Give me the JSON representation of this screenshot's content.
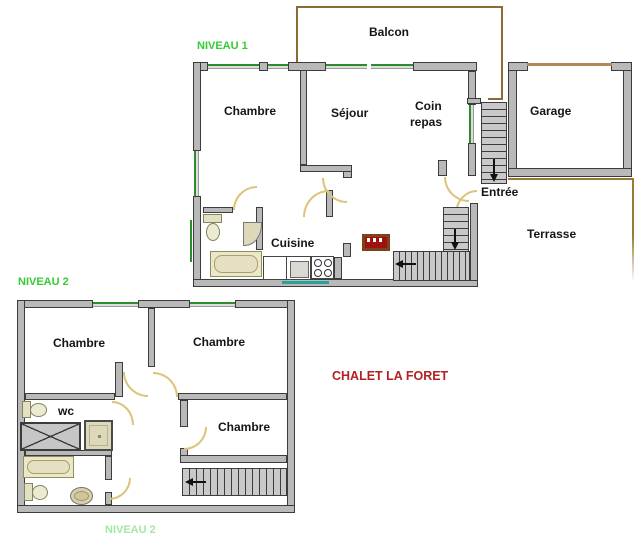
{
  "title": "CHALET LA FORET",
  "labels": {
    "niveau1": "NIVEAU 1",
    "niveau2": "NIVEAU 2",
    "balcon": "Balcon",
    "chambre_n1": "Chambre",
    "sejour": "Séjour",
    "coin_line1": "Coin",
    "coin_line2": "repas",
    "garage": "Garage",
    "entree": "Entrée",
    "cuisine": "Cuisine",
    "terrasse": "Terrasse",
    "chambre_n2_left": "Chambre",
    "chambre_n2_right": "Chambre",
    "chambre_n2_third": "Chambre",
    "wc": "wc",
    "chalet_title": "CHALET LA FORET",
    "partial_caption": "NIVEAU 2"
  },
  "colors": {
    "level_label": "#33cc33",
    "title_red": "#b22222",
    "wall_fill": "#b9b9b9",
    "wall_border": "#3c3c3c",
    "window_green": "#2e8b2e",
    "window_teal": "#2aa198",
    "balcony_brown": "#8a6a35",
    "garage_door_tan": "#b5885a",
    "door_arc": "#dcc37a",
    "stair_fill": "#c9c9c9"
  },
  "structure": {
    "levels": [
      {
        "label": "NIVEAU 1",
        "rooms": [
          "Chambre",
          "Séjour",
          "Coin repas",
          "Cuisine"
        ],
        "outside": [
          "Balcon",
          "Entrée",
          "Garage",
          "Terrasse"
        ],
        "fixtures": [
          "toilet",
          "corner-sink",
          "bathtub",
          "kitchen-counter",
          "stove",
          "fireplace"
        ],
        "stairs": [
          "entry-stairs-down",
          "interior-l-stairs"
        ]
      },
      {
        "label": "NIVEAU 2",
        "rooms": [
          "Chambre",
          "Chambre",
          "Chambre",
          "wc"
        ],
        "fixtures": [
          "toilet",
          "shower",
          "shower-tray",
          "bathtub",
          "toilet",
          "pedestal-sink"
        ],
        "stairs": [
          "straight-stairs"
        ]
      }
    ]
  }
}
